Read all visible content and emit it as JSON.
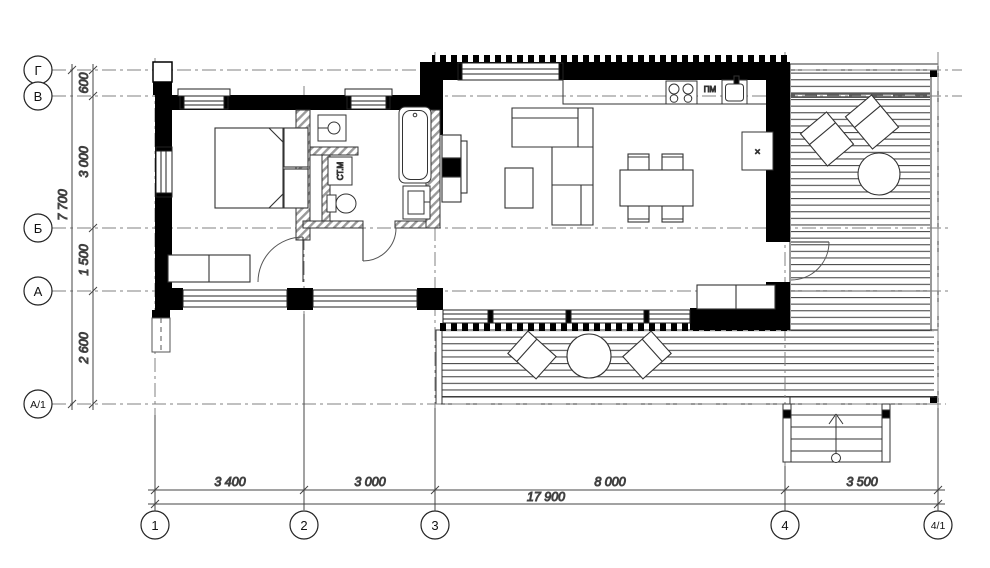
{
  "drawing": {
    "title": "floor-plan",
    "axis_labels_left": [
      "Г",
      "В",
      "Б",
      "А",
      "А/1"
    ],
    "axis_labels_bottom": [
      "1",
      "2",
      "3",
      "4",
      "4/1"
    ],
    "dims_left": {
      "d1": "600",
      "d2": "3 000",
      "d3": "1 500",
      "d4": "2 600",
      "total": "7 700"
    },
    "dims_bottom": {
      "d1": "3 400",
      "d2": "3 000",
      "d3": "8 000",
      "d4": "3 500",
      "total": "17 900"
    },
    "room_labels": {
      "dishwasher": "ПМ",
      "washing_machine": "СТ.М",
      "fridge_mark": "×"
    },
    "colors": {
      "wall": "#000000",
      "line": "#333333",
      "axis": "#808080",
      "deck_line": "#4a4a4a"
    }
  }
}
